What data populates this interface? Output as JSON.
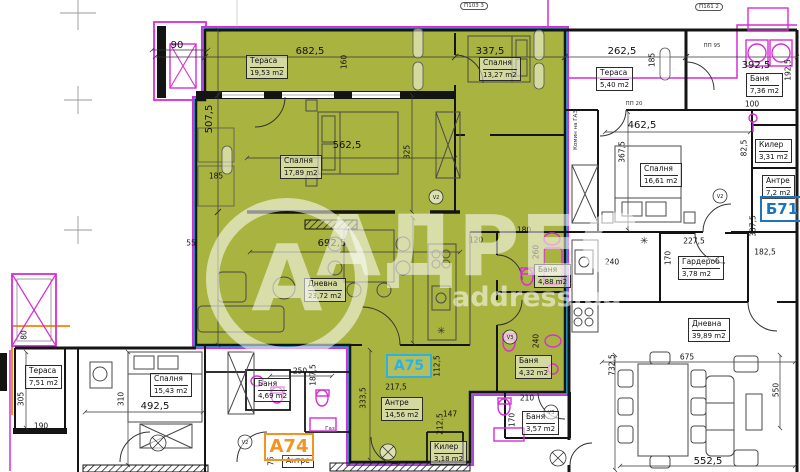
{
  "watermark": {
    "letter": "А",
    "brand": "АДРЕС",
    "site": "address.bg"
  },
  "badges": {
    "a75": "А75",
    "a74": "А74",
    "b71": "Б71"
  },
  "rooms": [
    {
      "name": "Тераса",
      "area": "19,53 m2"
    },
    {
      "name": "Спалня",
      "area": "13,27 m2"
    },
    {
      "name": "Спалня",
      "area": "17,89 m2"
    },
    {
      "name": "Дневна",
      "area": "23,72 m2"
    },
    {
      "name": "Антре",
      "area": "14,56 m2"
    },
    {
      "name": "Баня",
      "area": "4,88 m2"
    },
    {
      "name": "Баня",
      "area": "4,32 m2"
    },
    {
      "name": "Килер",
      "area": "3,18 m2"
    },
    {
      "name": "Тераса",
      "area": "5,40 m2"
    },
    {
      "name": "Баня",
      "area": "7,36 m2"
    },
    {
      "name": "Килер",
      "area": "3,31 m2"
    },
    {
      "name": "Спалня",
      "area": "16,61 m2"
    },
    {
      "name": "Антре",
      "area": "7,2 m2"
    },
    {
      "name": "Гардероб",
      "area": "3,78 m2"
    },
    {
      "name": "Дневна",
      "area": "39,89 m2"
    },
    {
      "name": "Тераса",
      "area": "7,51 m2"
    },
    {
      "name": "Спалня",
      "area": "15,43 m2"
    },
    {
      "name": "Баня",
      "area": "4,69 m2"
    },
    {
      "name": "Антре",
      "area": ""
    },
    {
      "name": "Баня",
      "area": "3,57 m2"
    }
  ],
  "dims": [
    "90",
    "682,5",
    "160",
    "337,5",
    "262,5",
    "185",
    "392,5",
    "192,5",
    "100",
    "507,5",
    "562,5",
    "325",
    "462,5",
    "367,5",
    "82,5",
    "185",
    "55",
    "692,5",
    "120",
    "180",
    "260",
    "240",
    "227,5",
    "170",
    "337,5",
    "182,5",
    "240",
    "250",
    "187,5",
    "305",
    "310",
    "190",
    "492,5",
    "333,5",
    "217,5",
    "112,5",
    "147",
    "212,5",
    "210",
    "170",
    "675",
    "732,5",
    "550",
    "552,5",
    "75",
    "80"
  ],
  "tags": {
    "pp95": "ПП 95",
    "pp20": "ПП 20",
    "gas": "Газ",
    "chimney": "Комин на ГАЗ",
    "oval1": "П103 3",
    "oval2": "П161 2"
  },
  "vents": {
    "v2": "V2",
    "v3": "V3"
  },
  "symbols": {
    "light": "✳"
  },
  "colors": {
    "highlight_green": "#a8b340",
    "outline_cyan": "#2ab2e8",
    "outline_magenta": "#d62ed6",
    "badge_a75": "#2ab2e8",
    "badge_a74": "#f6921e",
    "badge_b71": "#1c75bc",
    "wall_black": "#141414"
  }
}
